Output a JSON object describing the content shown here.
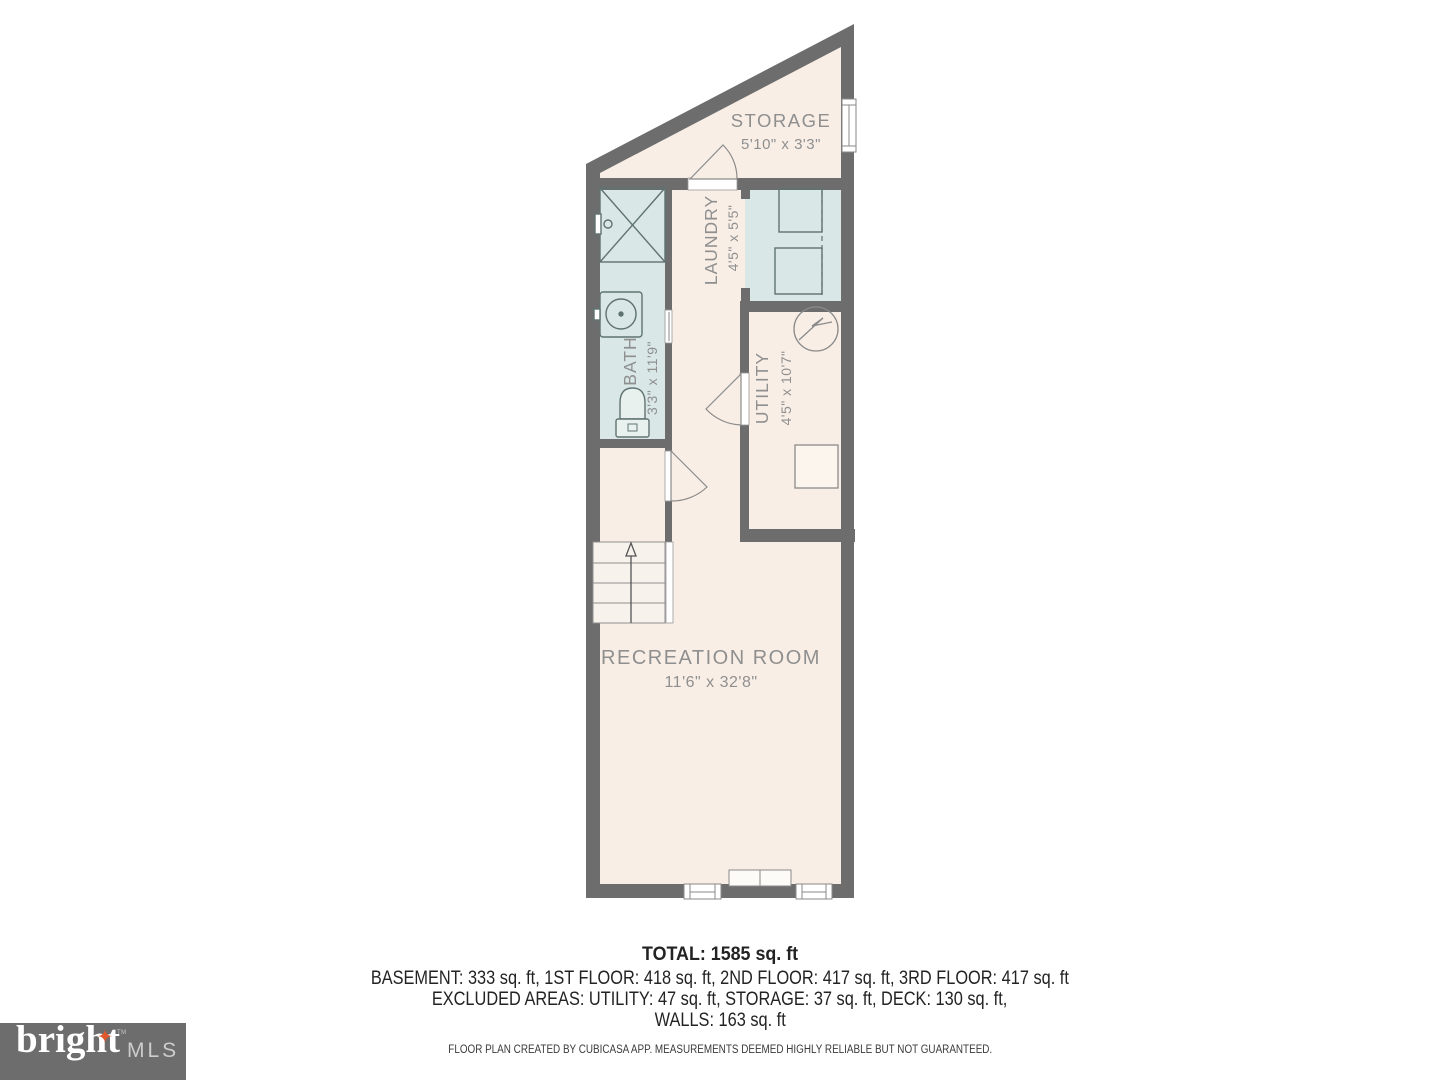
{
  "floor_plan": {
    "rooms": [
      {
        "name": "STORAGE",
        "dimensions": "5'10\" x 3'3\""
      },
      {
        "name": "LAUNDRY",
        "dimensions": "4'5\" x 5'5\""
      },
      {
        "name": "BATH",
        "dimensions": "3'3\" x 11'9\""
      },
      {
        "name": "UTILITY",
        "dimensions": "4'5\" x 10'7\""
      },
      {
        "name": "RECREATION ROOM",
        "dimensions": "11'6\" x 32'8\""
      }
    ],
    "colors": {
      "wall": "#6d6d6d",
      "floor": "#f8eee6",
      "wet_floor": "#d9e8e6",
      "label": "#8f8f8f",
      "fixture": "#5f7272"
    }
  },
  "summary": {
    "total": "TOTAL: 1585 sq. ft",
    "floors": "BASEMENT: 333 sq. ft, 1ST FLOOR: 418 sq. ft, 2ND FLOOR: 417 sq. ft, 3RD FLOOR: 417 sq. ft",
    "excluded": "EXCLUDED AREAS: UTILITY: 47 sq. ft, STORAGE: 37 sq. ft, DECK: 130 sq. ft,",
    "walls": "WALLS: 163 sq. ft"
  },
  "footer": {
    "disclaimer": "FLOOR PLAN CREATED BY CUBICASA APP. MEASUREMENTS DEEMED HIGHLY RELIABLE BUT NOT GUARANTEED."
  },
  "logo": {
    "brand": "bright",
    "suffix": "MLS",
    "trademark": "TM",
    "star_icon": "✦",
    "colors": {
      "background": "#6d6d6d",
      "brand": "#ffffff",
      "suffix": "#cdcdcd",
      "star": "#e2572b"
    }
  }
}
